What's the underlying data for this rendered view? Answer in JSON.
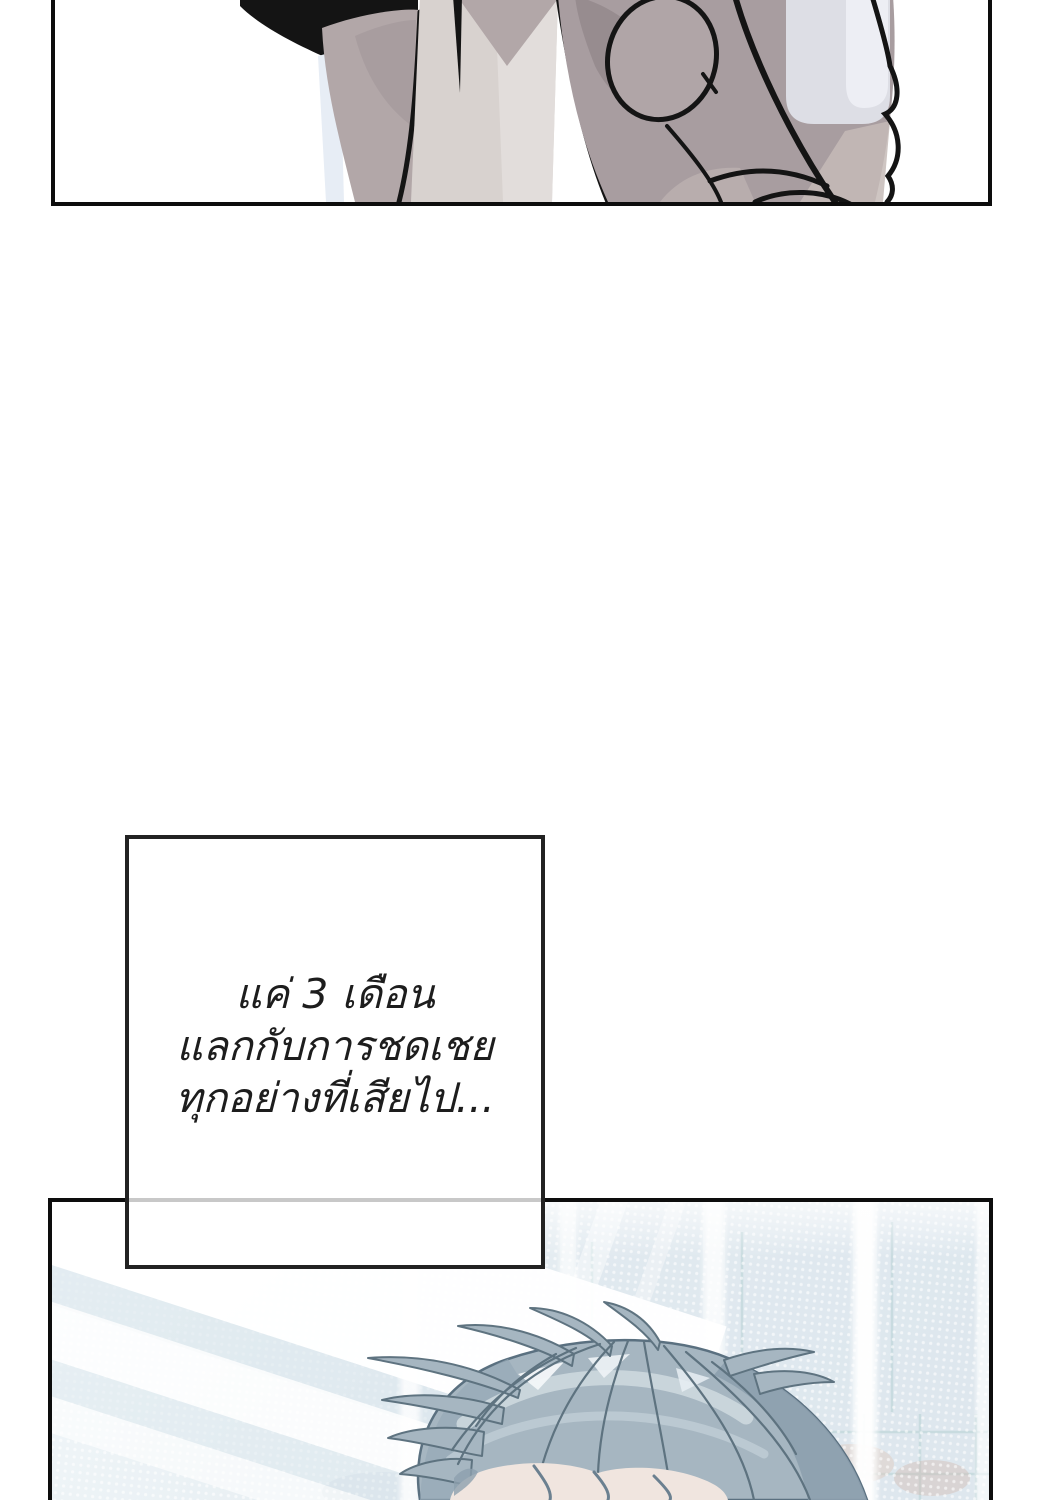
{
  "narration": {
    "lines": [
      "แค่ 3 เดือน",
      "แลกกับการชดเชย",
      "ทุกอย่างที่เสียไป..."
    ]
  },
  "panels": {
    "top": {
      "description": "Close-up black-and-white line art of a hand and sleeve, cropped by the page edge"
    },
    "bottom": {
      "description": "Character with grey-blue hair lowering his head before a bright window with halftone dots and light streaks"
    }
  },
  "colors": {
    "panel_border": "#0d0d0d",
    "narration_box_border": "#222222",
    "narration_text": "#1d1d1d",
    "border_overlap_line": "#c8c8c8",
    "hand_mauve": "#a89da0",
    "sleeve_grey": "#d8d2cf",
    "pale_highlight": "#dfe1e9",
    "hair_blue_grey": "#a6b6c1",
    "hair_line": "#5e7380",
    "skin": "#f0e5df",
    "backdrop_blue": "#e2ebf1"
  }
}
